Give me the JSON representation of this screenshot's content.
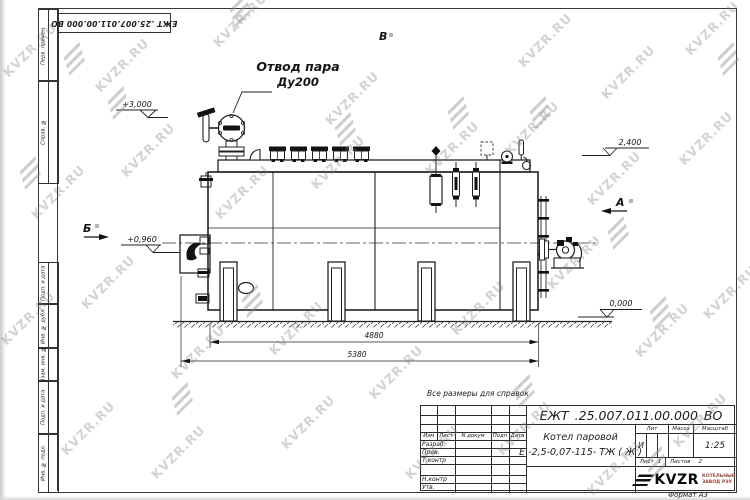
{
  "watermark": {
    "text": "KVZR.RU",
    "color": "#c8c8c8",
    "text_positions": [
      [
        30,
        50
      ],
      [
        122,
        65
      ],
      [
        240,
        20
      ],
      [
        352,
        98
      ],
      [
        545,
        40
      ],
      [
        628,
        72
      ],
      [
        712,
        28
      ],
      [
        58,
        192
      ],
      [
        148,
        150
      ],
      [
        242,
        192
      ],
      [
        338,
        162
      ],
      [
        452,
        148
      ],
      [
        532,
        128
      ],
      [
        614,
        178
      ],
      [
        706,
        138
      ],
      [
        28,
        318
      ],
      [
        108,
        282
      ],
      [
        198,
        352
      ],
      [
        296,
        328
      ],
      [
        396,
        372
      ],
      [
        478,
        308
      ],
      [
        574,
        262
      ],
      [
        662,
        330
      ],
      [
        730,
        292
      ],
      [
        88,
        428
      ],
      [
        178,
        452
      ],
      [
        308,
        422
      ],
      [
        432,
        452
      ],
      [
        524,
        428
      ],
      [
        614,
        468
      ],
      [
        700,
        420
      ]
    ],
    "icon_positions": [
      [
        74,
        58
      ],
      [
        240,
        10
      ],
      [
        118,
        102
      ],
      [
        345,
        128
      ],
      [
        458,
        112
      ],
      [
        540,
        112
      ],
      [
        30,
        172
      ],
      [
        252,
        300
      ],
      [
        660,
        312
      ],
      [
        728,
        58
      ],
      [
        524,
        390
      ],
      [
        656,
        462
      ],
      [
        182,
        398
      ],
      [
        618,
        232
      ]
    ]
  },
  "frame": {
    "top_designation": "ЕЖТ .25.007.011.00.000 ВО",
    "upper_margin_cells": [
      "Перв. примен.",
      "Справ. №"
    ],
    "lower_margin_cells": [
      "Подп. и дата",
      "Инв. № дубл.",
      "Взам. инв. №",
      "Подп. и дата",
      "Инв. № подл."
    ],
    "format_note": "Формат А3"
  },
  "annotations": {
    "reference_note": "Все размеры для справок",
    "callout_line1": "Отвод пара",
    "callout_line2": "Ду200",
    "view_top": "В",
    "view_left": "Б",
    "view_right": "А",
    "elev_top_left": "+3,000",
    "elev_mid_left": "+0,960",
    "elev_top_right": "2,400",
    "elev_ground": "0,000",
    "dim_inner": "4880",
    "dim_outer": "5380"
  },
  "title_block": {
    "designation": "ЕЖТ .25.007.011.00.000 ВО",
    "product_name_line1": "Котел паровой",
    "product_name_line2": "Е -2,5-0,07-115- ТЖ ( Ж )",
    "col_izm": "Изм",
    "col_list": "Лист",
    "col_doc": "N докум",
    "col_podp": "Подп",
    "col_data": "Дата",
    "row_razrab": "Разраб.",
    "row_prov": "Пров.",
    "row_tkontr": "Т.контр",
    "row_nkontr": "Н.контр",
    "row_utv": "Утв.",
    "lit_label": "Лит",
    "lit_value": "И",
    "mass_label": "Масса",
    "scale_label": "Масштаб",
    "scale_value": "1:25",
    "sheet_label": "Лист",
    "sheet_value": "1",
    "sheets_label": "Листов",
    "sheets_value": "2",
    "logo_text": "KVZR",
    "logo_caption_line1": "КОТЕЛЬНЫЙ",
    "logo_caption_line2": "ЗАВОД РЭУ"
  }
}
